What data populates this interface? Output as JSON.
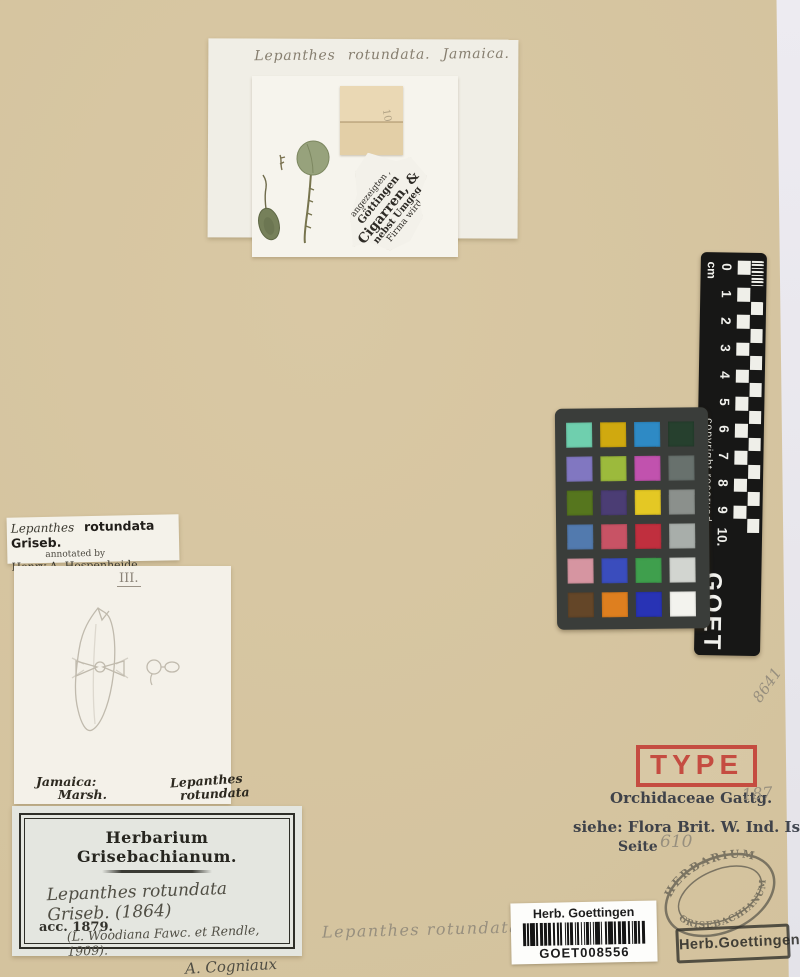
{
  "top_mount": {
    "determination": "Lepanthes rotundata.  Jamaica.",
    "packet_note": "10",
    "newspaper_lines": [
      "angezeigten ,",
      "Göttingen",
      "Cigarren, &",
      "nebst Umgeg",
      "Firma wird"
    ]
  },
  "ruler": {
    "unit_label": "cm",
    "ticks": [
      "0",
      "1",
      "2",
      "3",
      "4",
      "5",
      "6",
      "7",
      "8",
      "9",
      "10."
    ],
    "copyright_text": "copyright reserved",
    "institution_code": "GOET"
  },
  "color_checker": {
    "rows": 6,
    "cols": 4,
    "patches": [
      "#6FCFAE",
      "#D0A90F",
      "#2E8AC5",
      "#26402E",
      "#8177C1",
      "#9CBA3C",
      "#C152AE",
      "#68716D",
      "#56761E",
      "#4B3D74",
      "#E4C824",
      "#8B908C",
      "#527AAE",
      "#C85365",
      "#C02F3E",
      "#A8AEAA",
      "#D695A1",
      "#3A4DBD",
      "#3F9F4D",
      "#D2D5D0",
      "#644628",
      "#DE7F1F",
      "#2833B5",
      "#F3F3EE"
    ]
  },
  "annotation_label": {
    "genus": "Lepanthes",
    "species": "rotundata Griseb.",
    "annotated_by": "annotated by",
    "annotator": "Henry A. Hespenheide",
    "type_status": "HOLOTYPE"
  },
  "drawing_card": {
    "figure_number": "III.",
    "locality": "Jamaica:",
    "collector": "Marsh.",
    "name_line1": "Lepanthes",
    "name_line2": "rotundata"
  },
  "herbarium_label": {
    "title": "Herbarium Grisebachianum.",
    "name_line": "Lepanthes rotundata Griseb. (1864)",
    "synonym_line": "(L. Woodiana Fawc. et Rendle, 1909).",
    "signature": "A. Cogniaux",
    "accession": "acc. 1879."
  },
  "type_stamp": {
    "text": "TYPE",
    "color": "#c5463c"
  },
  "reference_stamp": {
    "line1": "Orchidaceae Gattg.",
    "line1_number": "187",
    "line2": "siehe: Flora Brit. W. Ind. Isl.",
    "line3_label": "Seite",
    "line3_number": "610"
  },
  "barcode_label": {
    "institution": "Herb. Goettingen",
    "code": "GOET008556"
  },
  "oval_stamp": {
    "arc_top": "HERBARIUM",
    "arc_bottom": "GRISEBACHIANUM"
  },
  "box_stamp": {
    "text": "Herb.Goettingen"
  },
  "pencil_annotations": {
    "determination": "Lepanthes rotundata",
    "number": "8641"
  }
}
